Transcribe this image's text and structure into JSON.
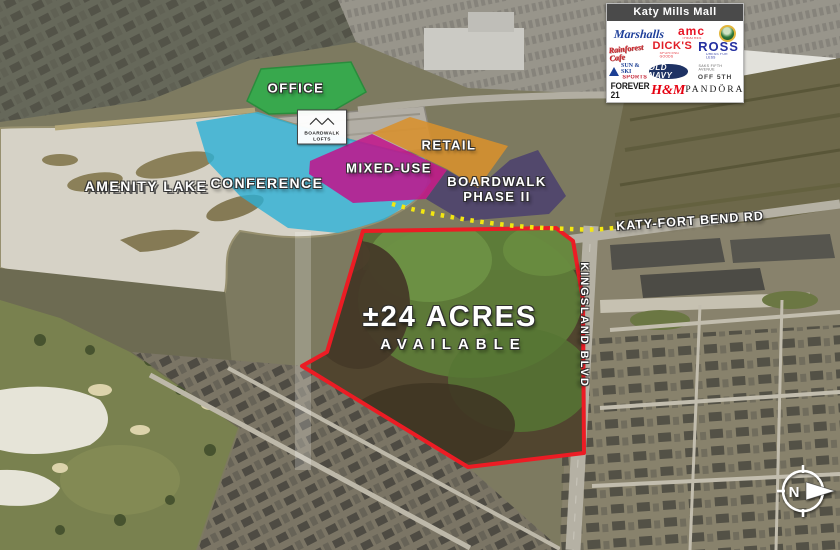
{
  "map": {
    "zones": [
      {
        "id": "office",
        "label": "OFFICE",
        "color": "#2faf4b"
      },
      {
        "id": "conference",
        "label": "CONFERENCE",
        "color": "#2cb0d6"
      },
      {
        "id": "mixed-use",
        "label": "MIXED-USE",
        "color": "#c2138b"
      },
      {
        "id": "retail",
        "label": "RETAIL",
        "color": "#d8912c"
      },
      {
        "id": "boardwalk-phase-2",
        "label": "BOARDWALK",
        "label2": "PHASE II",
        "color": "#4a3f6e"
      }
    ],
    "site": {
      "acres_line1": "±24 ACRES",
      "acres_line2": "AVAILABLE",
      "outline_color": "#ec1c24"
    },
    "roads": {
      "katy_fort_bend": "KATY-FORT BEND RD",
      "kingsland": "KINGSLAND BLVD"
    },
    "water": {
      "amenity_lake": "AMENITY LAKE"
    },
    "boardwalk_lofts": {
      "line1": "BOARDWALK",
      "line2": "LOFTS"
    },
    "path_color": "#f3e711",
    "compass_north": "N"
  },
  "tenant_box": {
    "title": "Katy Mills Mall",
    "logos": [
      {
        "name": "marshalls",
        "text": "Marshalls",
        "color": "#1e3f9a"
      },
      {
        "name": "amc-theatres",
        "text": "amc",
        "sub": "THEATRES",
        "color": "#e71324"
      },
      {
        "name": "bass-pro-shops",
        "text": "",
        "color": "#2e7a3a"
      },
      {
        "name": "rainforest-cafe",
        "text": "Rainforest Cafe",
        "color": "#cf2027"
      },
      {
        "name": "dicks-sporting-goods",
        "text": "DICK'S",
        "sub": "SPORTING GOODS",
        "color": "#e11d26"
      },
      {
        "name": "ross-dress-for-less",
        "text": "ROSS",
        "sub": "DRESS FOR LESS",
        "color": "#2430a0"
      },
      {
        "name": "sun-and-ski-sports",
        "text": "SUN & SKI",
        "sub": "SPORTS",
        "color": "#1c3f94"
      },
      {
        "name": "old-navy",
        "text": "OLD NAVY",
        "color": "#1e3264"
      },
      {
        "name": "saks-off-5th",
        "text": "SAKS FIFTH AVENUE",
        "sub": "OFF 5TH",
        "color": "#555555"
      },
      {
        "name": "forever-21",
        "text": "FOREVER 21",
        "color": "#1a1a1a"
      },
      {
        "name": "h-and-m",
        "text": "H&M",
        "color": "#e50010"
      },
      {
        "name": "pandora",
        "text": "PANDÖRA",
        "color": "#1a1a1a"
      }
    ]
  }
}
